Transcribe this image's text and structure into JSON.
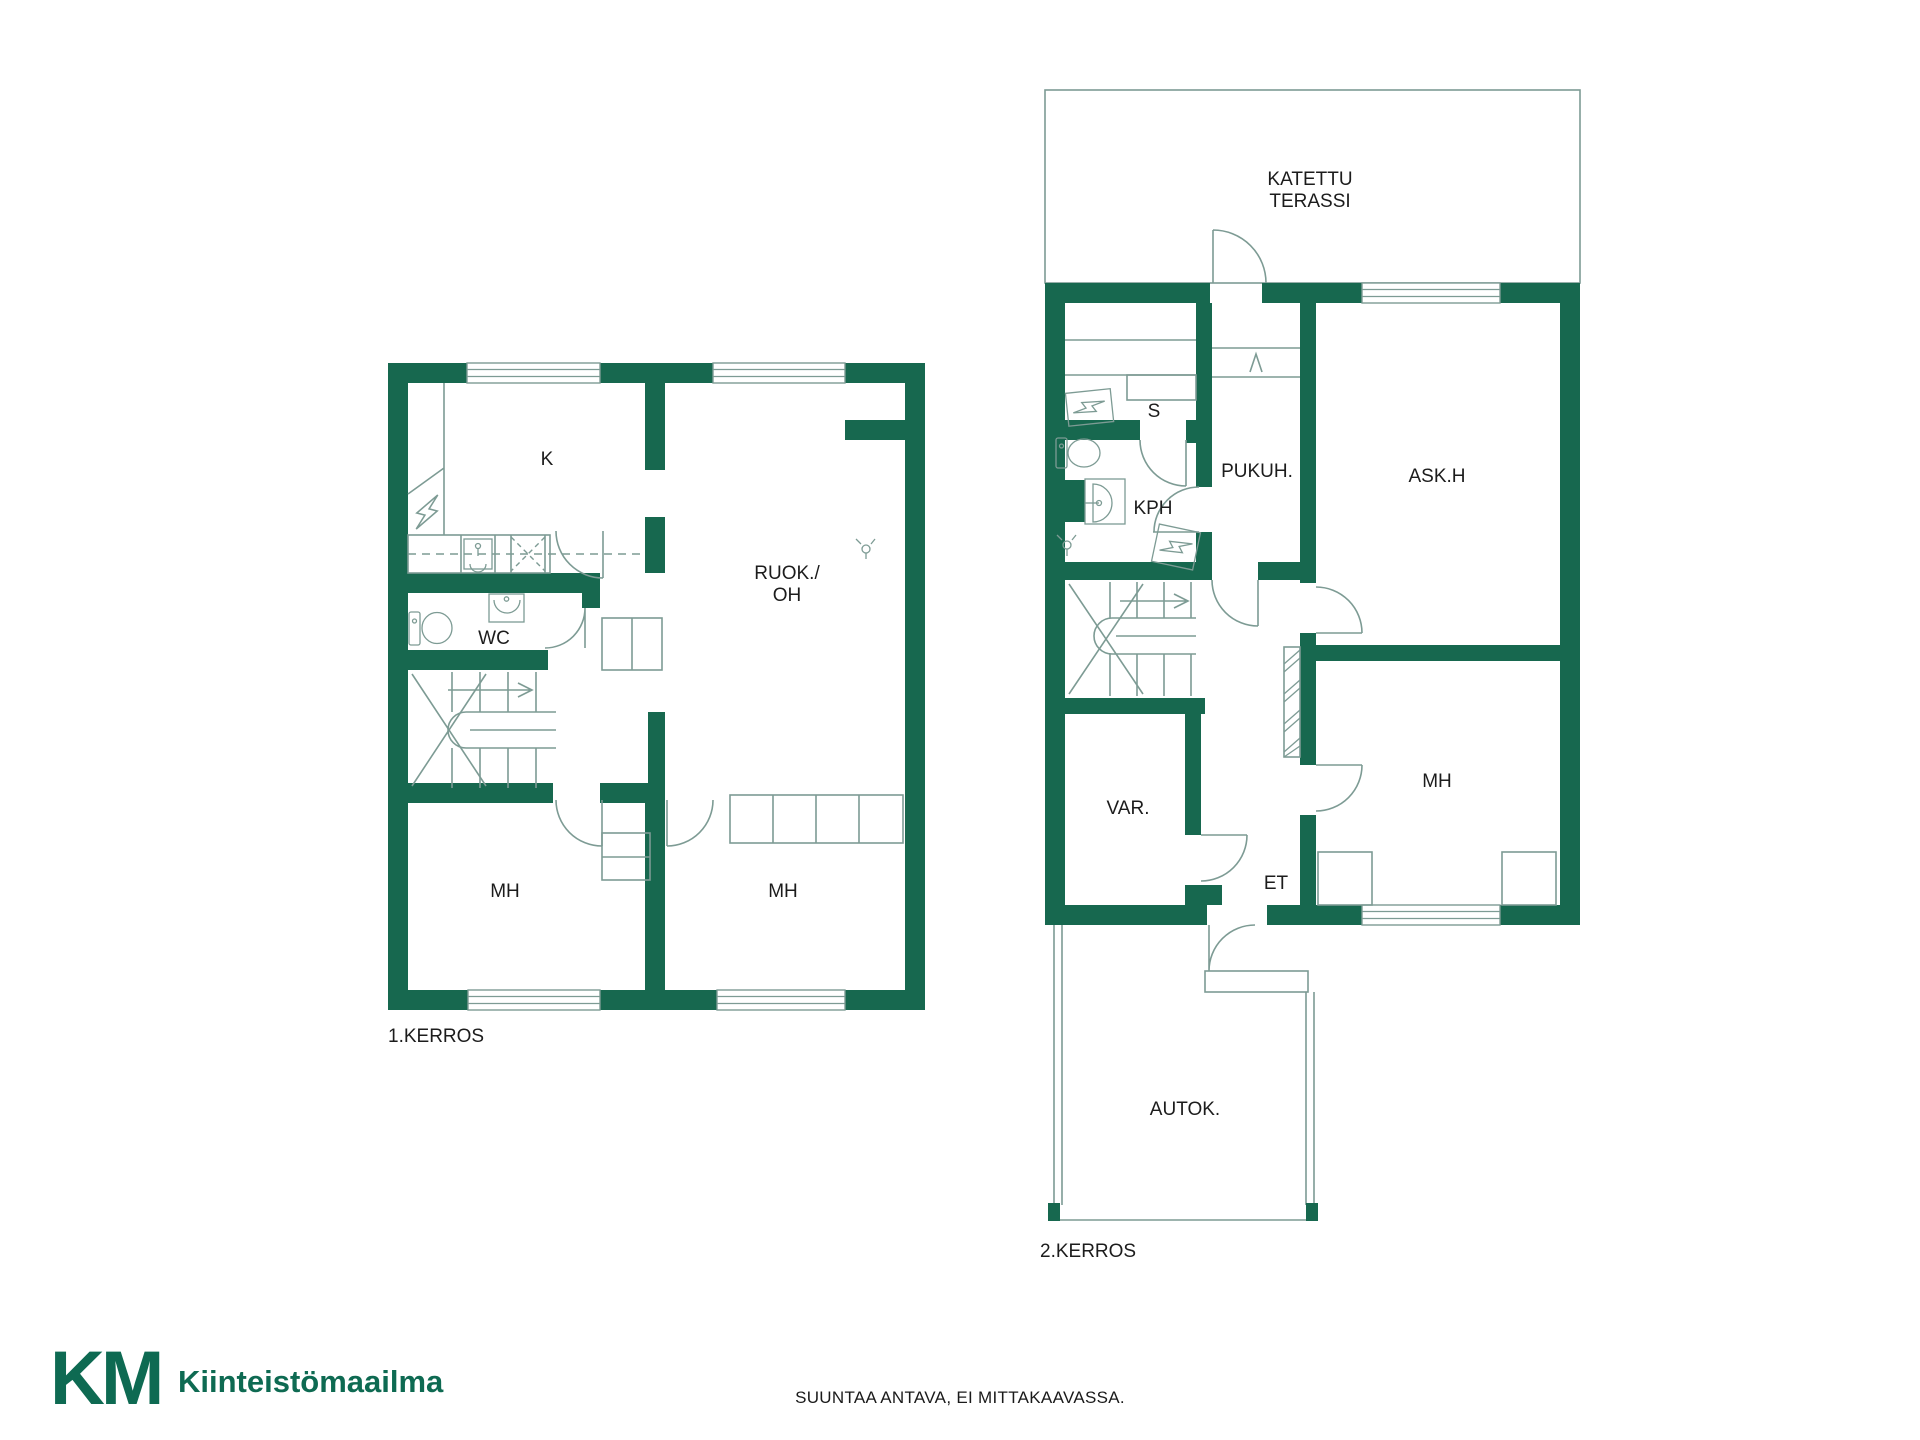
{
  "colors": {
    "wall_green": "#17684F",
    "line_teal": "#7D9B94",
    "label_black": "#1C1C1C",
    "logo_green": "#0E6A52",
    "logo_lime": "#C8DA2F"
  },
  "floor1": {
    "name_label": "1.KERROS",
    "rooms": {
      "kitchen": "K",
      "dining_living_line1": "RUOK./",
      "dining_living_line2": "OH",
      "wc": "WC",
      "bedroom_left": "MH",
      "bedroom_right": "MH"
    }
  },
  "floor2": {
    "name_label": "2.KERROS",
    "terrace_line1": "KATETTU",
    "terrace_line2": "TERASSI",
    "rooms": {
      "sauna": "S",
      "bathroom": "KPH",
      "dressing_room": "PUKUH.",
      "hobby_room": "ASK.H",
      "storage": "VAR.",
      "entry": "ET",
      "bedroom": "MH",
      "garage": "AUTOK."
    }
  },
  "footer": {
    "logo_k": "K",
    "logo_m": "M",
    "brand_name": "Kiinteistömaailma",
    "disclaimer": "SUUNTAA ANTAVA, EI MITTAKAAVASSA."
  }
}
